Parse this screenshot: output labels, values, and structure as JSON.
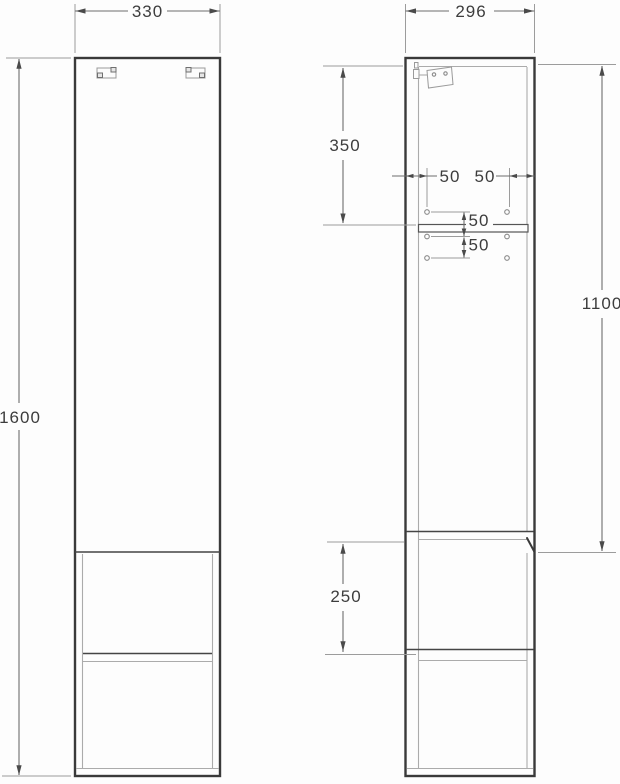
{
  "drawing": {
    "kind": "cabinet-technical-drawing",
    "colors": {
      "outline_dark": "#3a3a3a",
      "inner_line_light": "#ababab",
      "dimension_line": "#6d6d6d",
      "label_text": "#3d3d3d",
      "background": "#fdfdfd"
    },
    "front_view": {
      "width": "330",
      "height": "1600"
    },
    "side_view": {
      "depth": "296",
      "top_to_shelf": "350",
      "hole_inset_left": "50",
      "hole_inset_right": "50",
      "hole_pitch_upper": "50",
      "hole_pitch_lower": "50",
      "door_height": "1100",
      "niche_height": "250"
    }
  }
}
